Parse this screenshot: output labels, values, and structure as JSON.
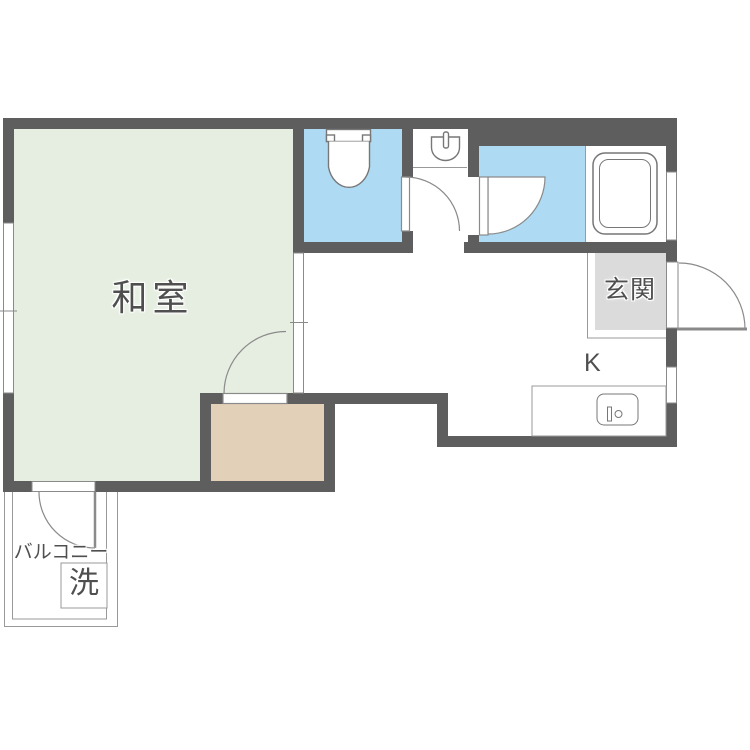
{
  "floorplan": {
    "labels": {
      "washitsu": "和室",
      "genkan": "玄関",
      "kitchen": "K",
      "balcony": "バルコニー",
      "laundry": "洗"
    },
    "colors": {
      "wall": "#5e5e5e",
      "tatami": "#e6eee1",
      "water": "#aedbf3",
      "closet": "#e2d0b8",
      "entry": "#dbdbdb",
      "outline": "#8a8a8a",
      "fixture": "#777777",
      "thin": "#999999",
      "text": "#4f4f4f"
    },
    "fixtures": [
      "toilet-icon",
      "hand-sink-icon",
      "bathtub-icon",
      "kitchen-sink-icon",
      "washing-machine-icon",
      "door-swing-icon",
      "window-icon"
    ]
  }
}
